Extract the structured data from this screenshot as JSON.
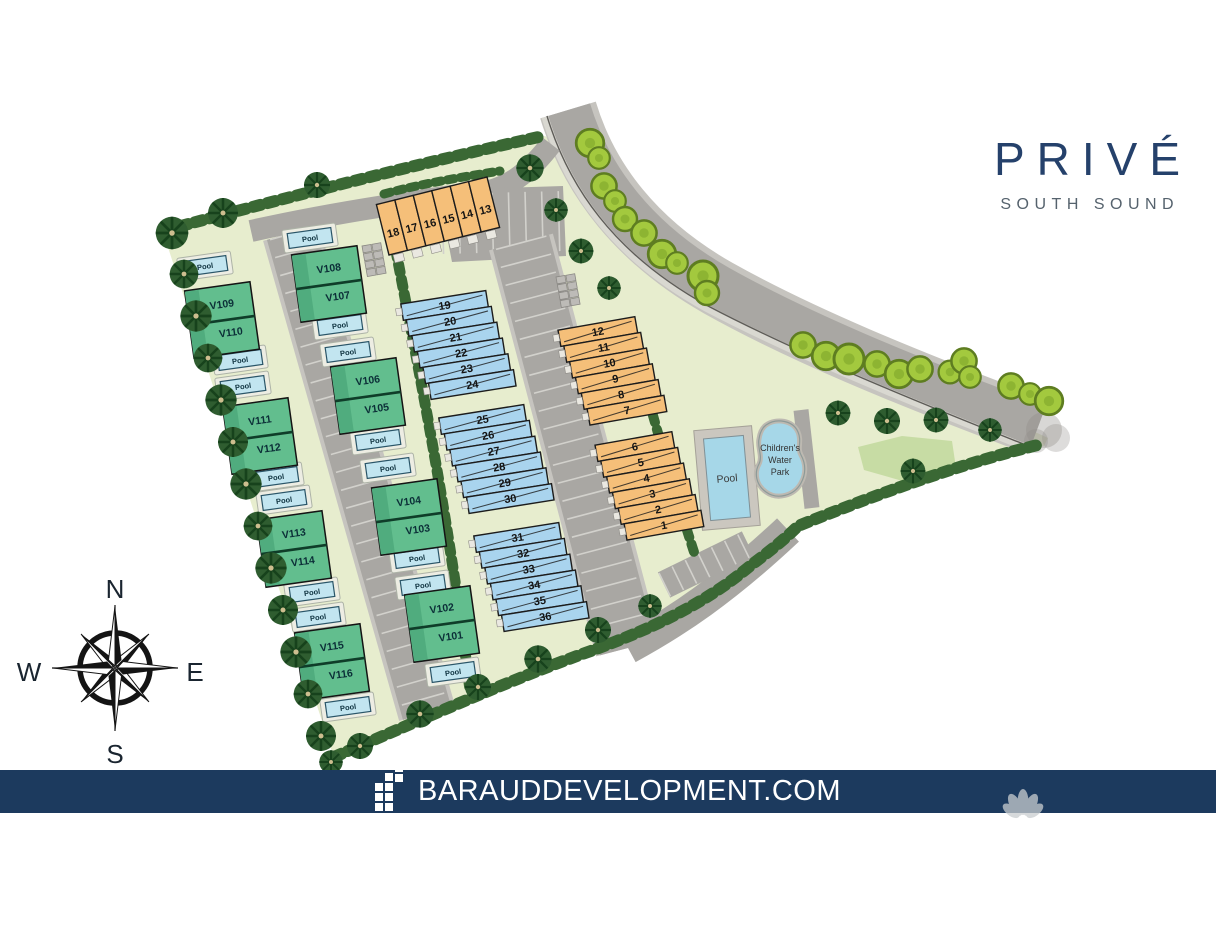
{
  "brand": {
    "title": "PRIVÉ",
    "subtitle": "SOUTH SOUND"
  },
  "footer": {
    "website": "BARAUDDEVELOPMENT.COM"
  },
  "compass": {
    "north": "N",
    "east": "E",
    "south": "S",
    "west": "W"
  },
  "labels": {
    "villa_pool": "Pool",
    "amenity_pool": "Pool",
    "water_park": [
      "Children's",
      "Water",
      "Park"
    ]
  },
  "villas": {
    "left_column": [
      [
        "V109",
        "V110"
      ],
      [
        "V111",
        "V112"
      ],
      [
        "V113",
        "V114"
      ],
      [
        "V115",
        "V116"
      ]
    ],
    "middle_column": [
      [
        "V108",
        "V107"
      ],
      [
        "V106",
        "V105"
      ],
      [
        "V104",
        "V103"
      ],
      [
        "V102",
        "V101"
      ]
    ]
  },
  "townhouses": {
    "orange_top": [
      "18",
      "17",
      "16",
      "15",
      "14",
      "13"
    ],
    "orange_upper": [
      "12",
      "11",
      "10",
      "9",
      "8",
      "7"
    ],
    "orange_lower": [
      "6",
      "5",
      "4",
      "3",
      "2",
      "1"
    ],
    "blue_upper": [
      "19",
      "20",
      "21",
      "22",
      "23",
      "24"
    ],
    "blue_middle": [
      "25",
      "26",
      "27",
      "28",
      "29",
      "30"
    ],
    "blue_lower": [
      "31",
      "32",
      "33",
      "34",
      "35",
      "36"
    ]
  },
  "colors": {
    "brand_navy": "#1C3A5E",
    "logo_navy": "#25416B",
    "villa_green": "#62BE8E",
    "townhouse_blue": "#A9D4EE",
    "townhouse_orange": "#F5BF79",
    "pool_blue": "#C2E5F0",
    "terrain_green": "#E7EDCE",
    "road_gray": "#A9A7A3"
  }
}
